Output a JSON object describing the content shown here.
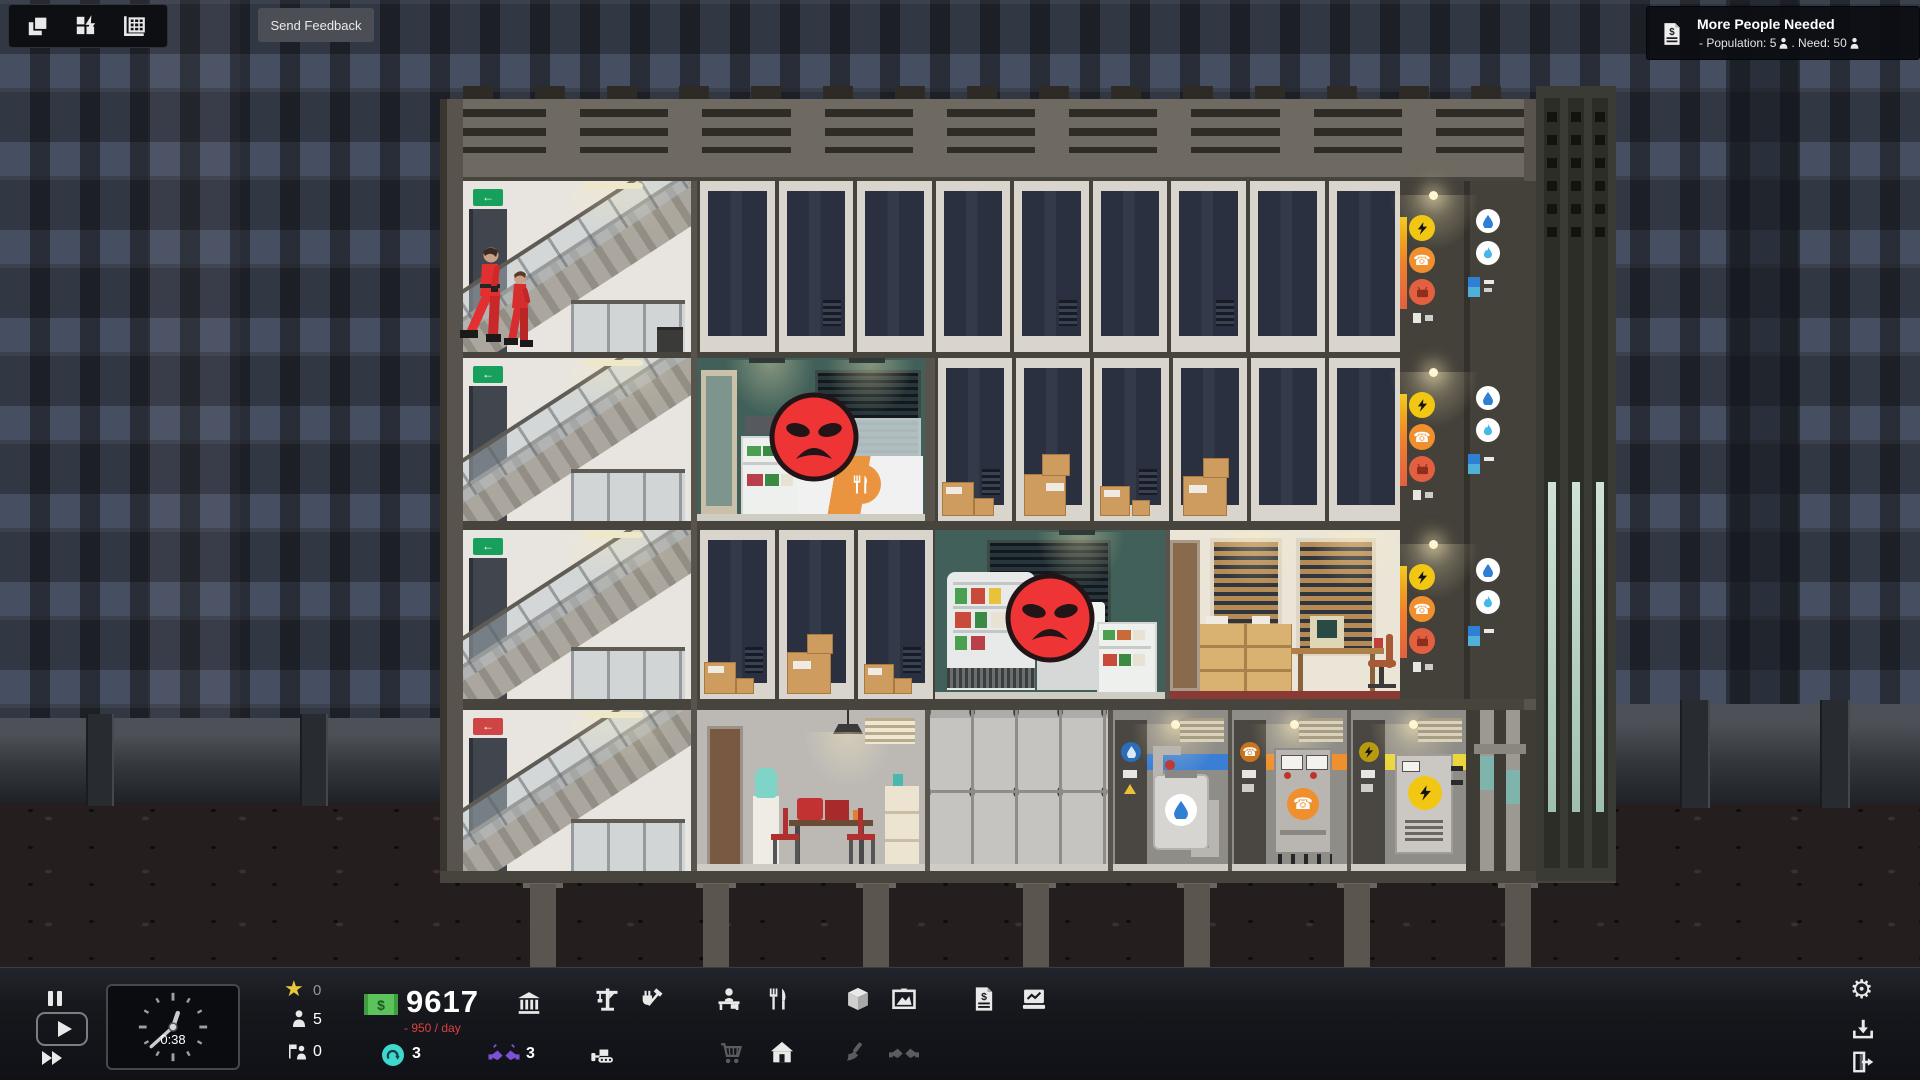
{
  "top_toolbar": {
    "icons": [
      {
        "name": "layers-overlay"
      },
      {
        "name": "power-overlay"
      },
      {
        "name": "building-overlay"
      }
    ]
  },
  "feedback_button": {
    "label": "Send Feedback"
  },
  "notification": {
    "title": "More People Needed",
    "pop_text": "- Population: 5",
    "need_text": ". Need: 50"
  },
  "hud": {
    "time": "0:38",
    "stars": "0",
    "population": "5",
    "workers": "0",
    "money": "9617",
    "money_symbol": "$",
    "cashflow": "- 950 / day",
    "materials": "3",
    "consultants": "3"
  },
  "icons": {
    "star": "★",
    "gear": "⚙",
    "phone": "☎",
    "exit_arrow": "←",
    "basement_sign": "←"
  },
  "colors": {
    "star_yellow": "#e8c83c",
    "money_green": "#5cc25c",
    "negative_red": "#e04040",
    "materials_cyan": "#3fd8cc",
    "consultants_purple": "#7b52d6",
    "power_yellow": "#f2c713",
    "phone_orange": "#ef8f2e",
    "cable_red": "#e2603f",
    "water_blue": "#3a7fd4",
    "gas_blue": "#45b8e8",
    "angry_red": "#ee3434"
  }
}
